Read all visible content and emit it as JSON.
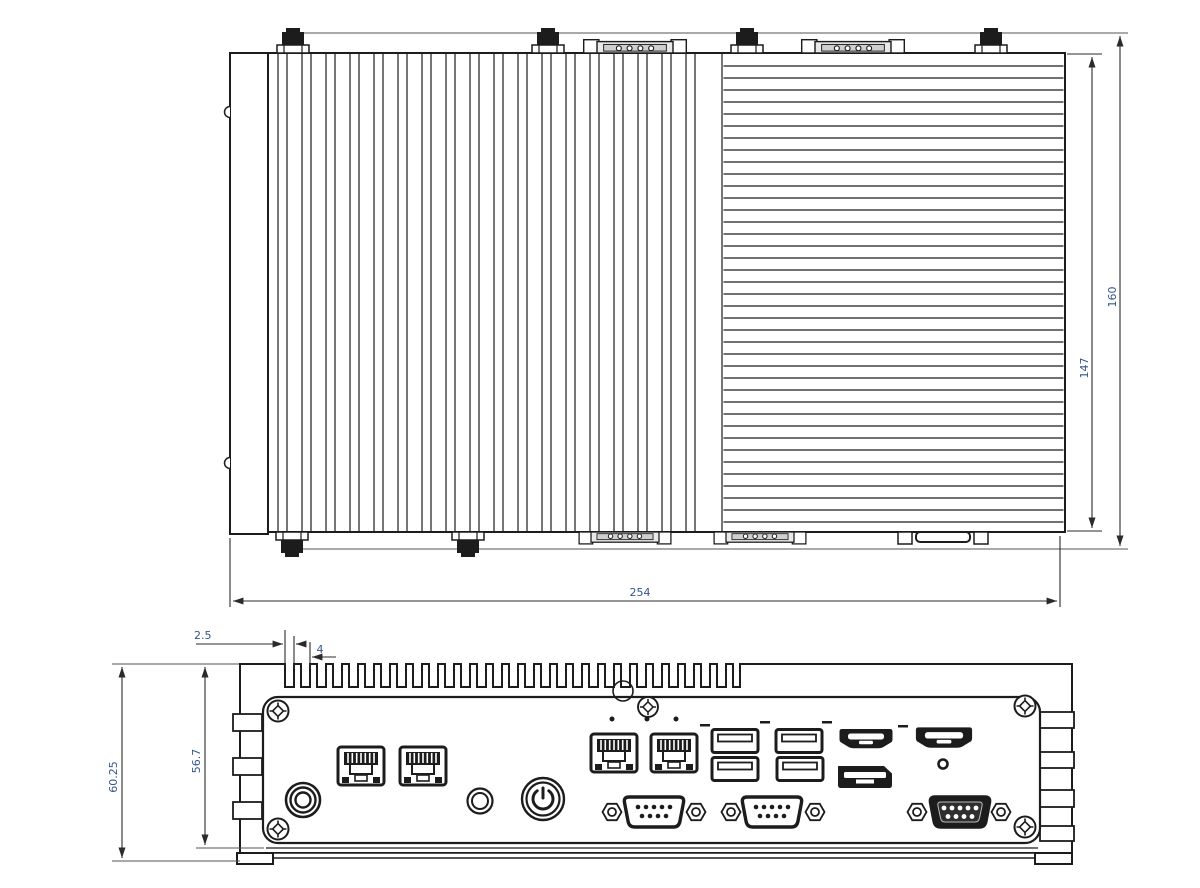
{
  "page": {
    "background": "#ffffff"
  },
  "colors": {
    "line": "#1c1c1c",
    "dim_line": "#2b2b2b",
    "dim_text": "#35548b",
    "connector_fill": "#1c1c1c"
  },
  "dimensions": {
    "top_view": {
      "width": "254",
      "height_outer": "160",
      "height_inner": "147"
    },
    "front_view": {
      "fin_gap": "2.5",
      "fin_pitch": "4",
      "height_outer": "60.25",
      "height_inner": "56.7"
    }
  },
  "icons": {
    "top_view": [
      "mounting-flange",
      "flange-bump",
      "flange-bump",
      "antenna-connector",
      "antenna-connector",
      "antenna-connector",
      "antenna-connector",
      "antenna-connector",
      "antenna-connector",
      "db9-edge-connector",
      "db9-edge-connector",
      "db9-edge-connector",
      "db9-edge-connector",
      "hdmi-edge-connector",
      "heatsink-fins-vertical",
      "heatsink-fins-horizontal"
    ],
    "front_panel": [
      "dc-power-jack",
      "lan-port",
      "lan-port",
      "antenna-hole",
      "power-button",
      "lan-port",
      "lan-port",
      "usb-port",
      "usb-port",
      "usb-port",
      "usb-port",
      "hdmi-port",
      "displayport",
      "hdmi-port",
      "reset-hole",
      "db9-com-port",
      "db9-com-port",
      "db9-com-port-female",
      "corner-screw",
      "corner-screw",
      "corner-screw",
      "corner-screw",
      "center-screw",
      "detail-callout-circle",
      "status-led",
      "status-led",
      "status-led",
      "port-marker-dash",
      "port-marker-dash",
      "port-marker-dash",
      "port-marker-dash",
      "chassis-foot",
      "chassis-foot",
      "heatsink-teeth",
      "side-comb",
      "side-comb"
    ]
  }
}
